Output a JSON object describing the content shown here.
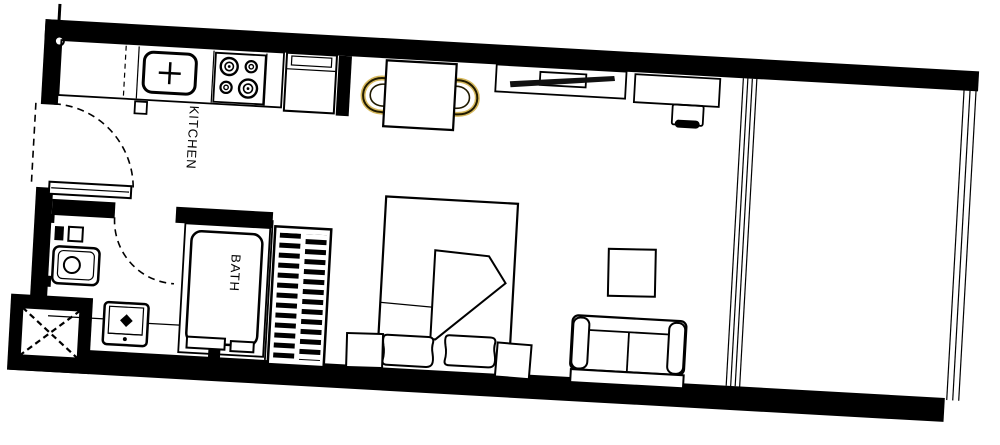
{
  "document": {
    "type": "floor-plan",
    "title": "Studio apartment floor plan"
  },
  "plan": {
    "labels": {
      "kitchen": "KITCHEN",
      "bath": "BATH"
    },
    "colors": {
      "wall": "#000000",
      "background": "#ffffff",
      "line": "#000000",
      "chair_accent": "#c9a227"
    },
    "rooms": [
      {
        "id": "kitchen",
        "label": "KITCHEN"
      },
      {
        "id": "bath",
        "label": "BATH"
      }
    ],
    "fixtures": [
      "kitchen-counter",
      "kitchen-sink",
      "cooktop-4-burner",
      "kitchen-cabinet",
      "entry-door",
      "entry-shelf",
      "duct-shaft",
      "bathtub",
      "bath-faucet",
      "washbasin-vanity",
      "shower-unit",
      "bath-door",
      "slatted-wardrobe",
      "dining-table",
      "dining-chair",
      "tv-console",
      "tv",
      "desk",
      "desk-chair",
      "double-bed",
      "blanket",
      "pillow",
      "nightstand",
      "coffee-table",
      "sofa-two-seat",
      "glass-partition",
      "balcony",
      "balcony-railing"
    ]
  }
}
